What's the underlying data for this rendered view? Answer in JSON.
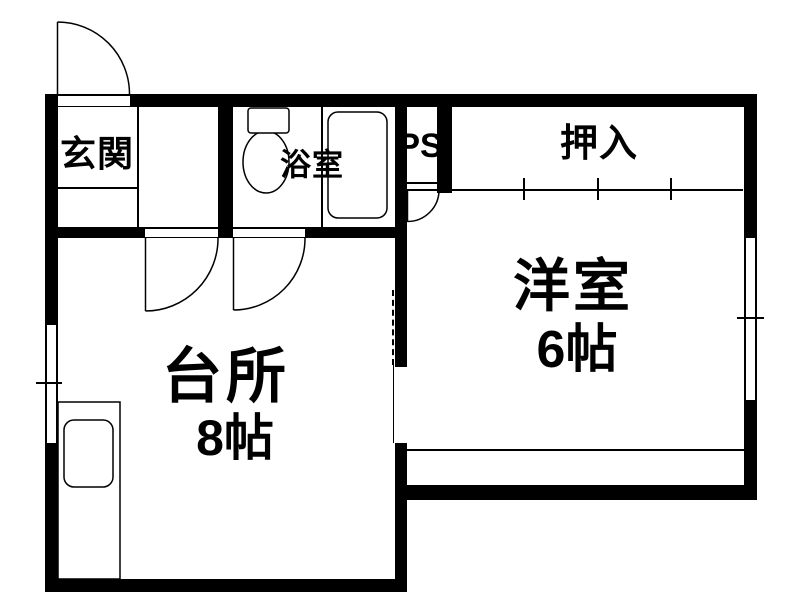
{
  "floorplan": {
    "type": "apartment-floor-plan",
    "rooms": {
      "genkan": {
        "label": "玄関"
      },
      "bathroom": {
        "label": "浴室"
      },
      "ps": {
        "label": "PS"
      },
      "oshiire": {
        "label": "押入"
      },
      "western_room": {
        "label": "洋室",
        "size": "6帖"
      },
      "kitchen": {
        "label": "台所",
        "size": "8帖"
      }
    },
    "colors": {
      "wall": "#000000",
      "line": "#000000",
      "background": "#ffffff"
    }
  }
}
